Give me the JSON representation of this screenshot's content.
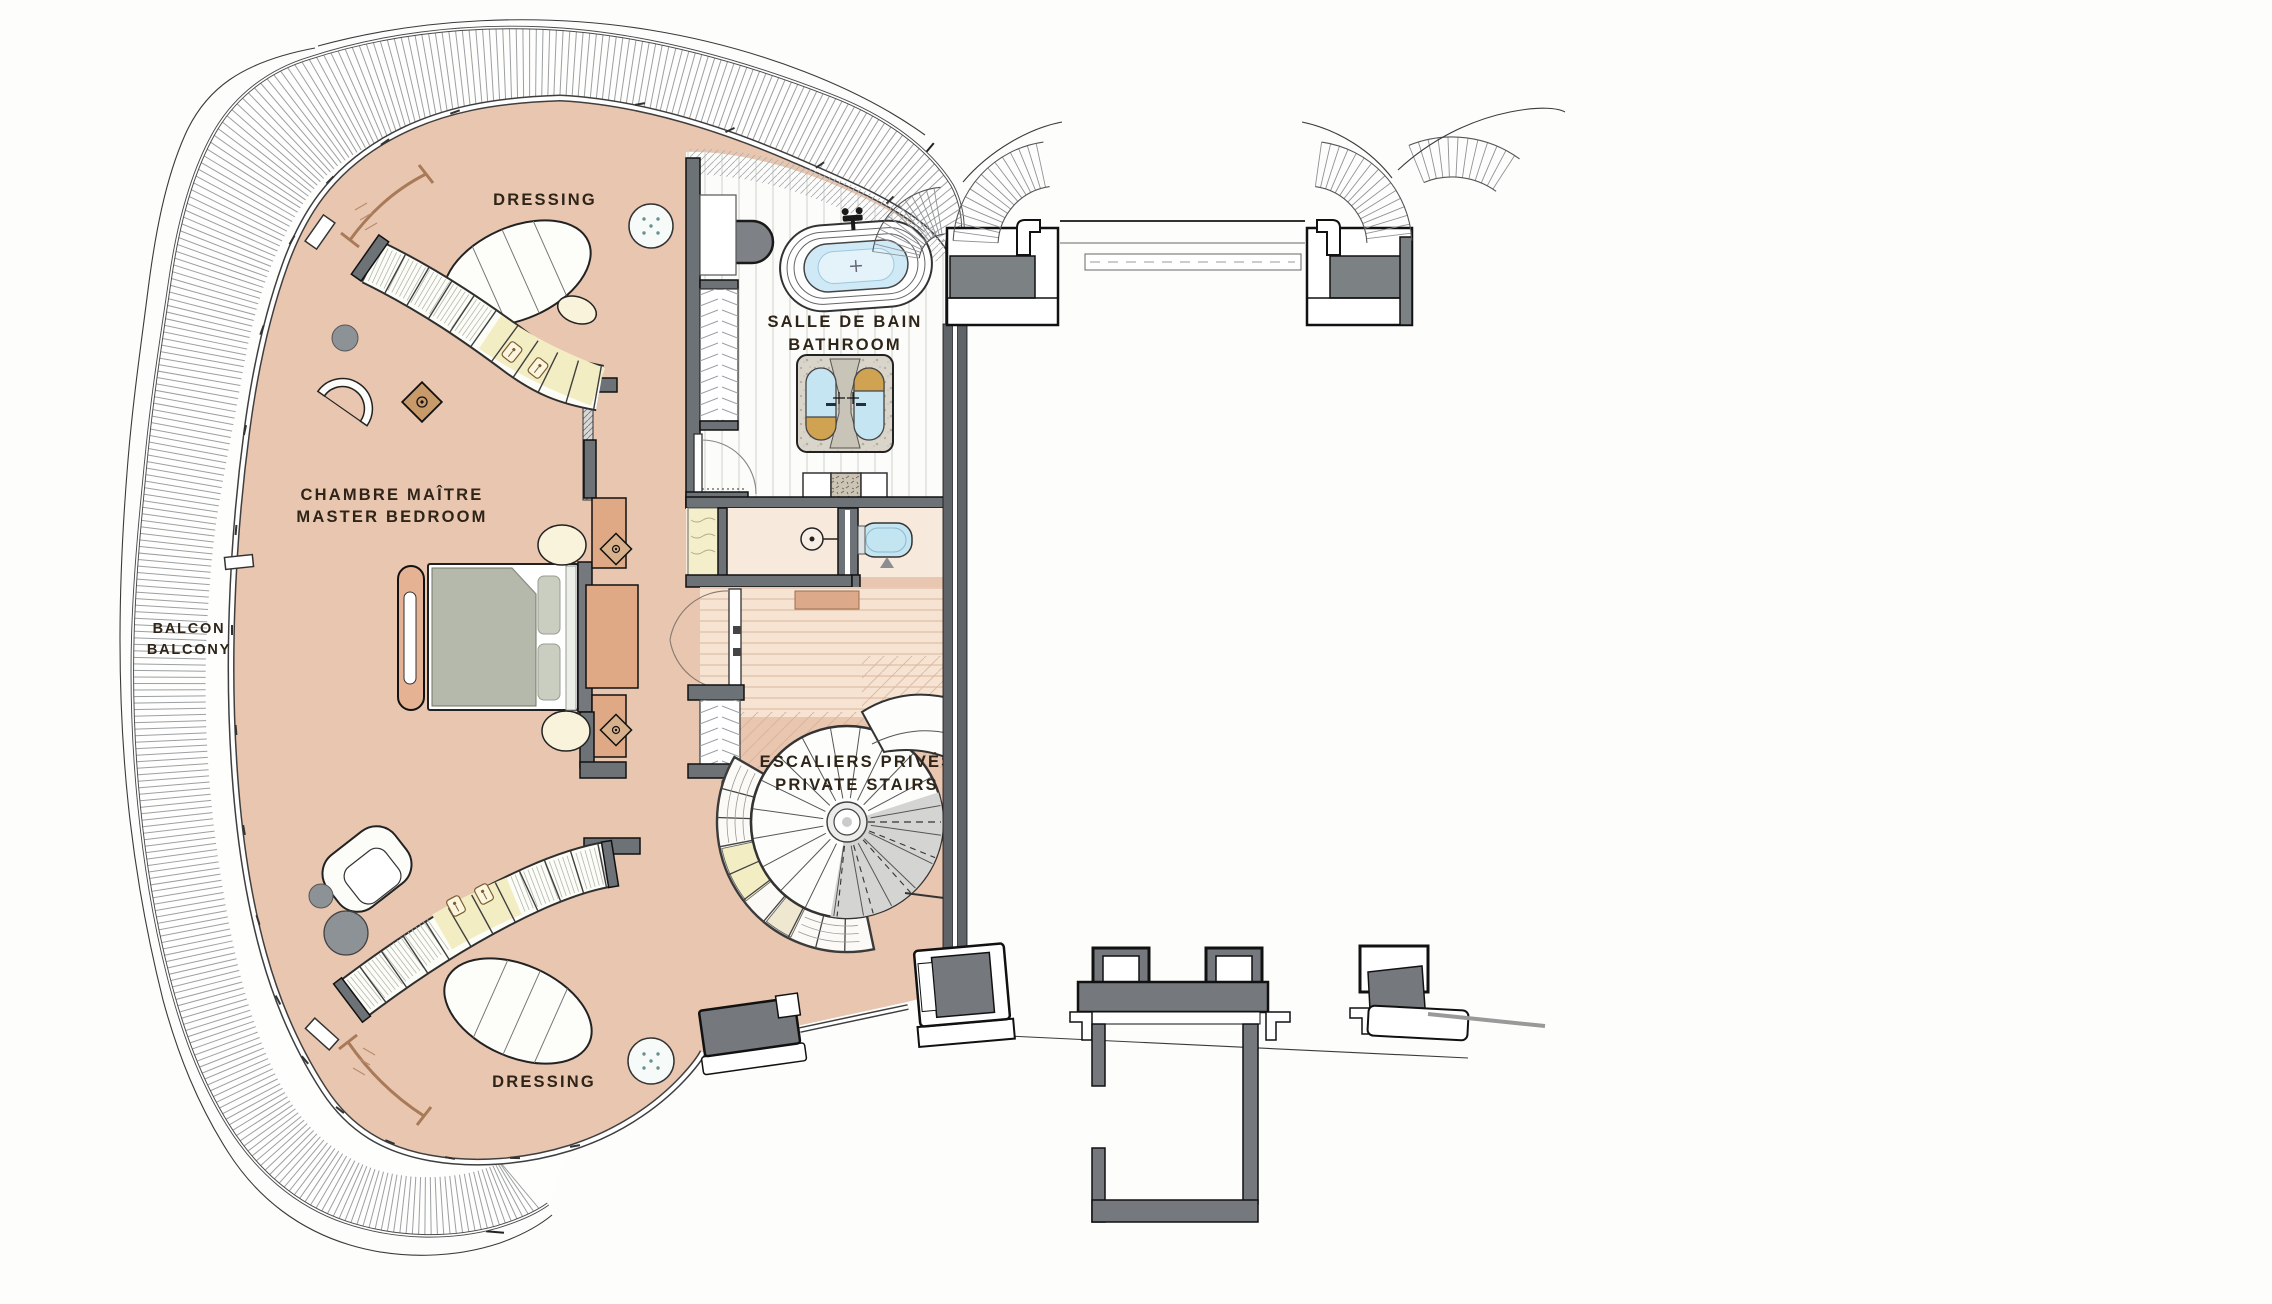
{
  "plan": {
    "type": "architectural-floor-plan",
    "labels": {
      "dressing_top": "DRESSING",
      "bathroom_fr": "SALLE DE BAIN",
      "bathroom_en": "BATHROOM",
      "bedroom_fr": "CHAMBRE MAÎTRE",
      "bedroom_en": "MASTER BEDROOM",
      "balcony_fr": "BALCON",
      "balcony_en": "BALCONY",
      "stairs_fr": "ESCALIERS PRIVÉS",
      "stairs_en": "PRIVATE STAIRS",
      "dressing_bottom": "DRESSING"
    },
    "colors": {
      "floor_pink": "#e9c6b0",
      "floor_hall": "#f6e3d2",
      "floor_wc": "#f7e9dc",
      "wall_gray": "#6d7277",
      "water_blue": "#cfeaf6",
      "duvet_green": "#b4b9ab",
      "panel_salmon": "#dfa986",
      "cabinet_yellow": "#f5eecb",
      "brass_gold": "#cfa352",
      "label_ink": "#2e2418"
    }
  }
}
